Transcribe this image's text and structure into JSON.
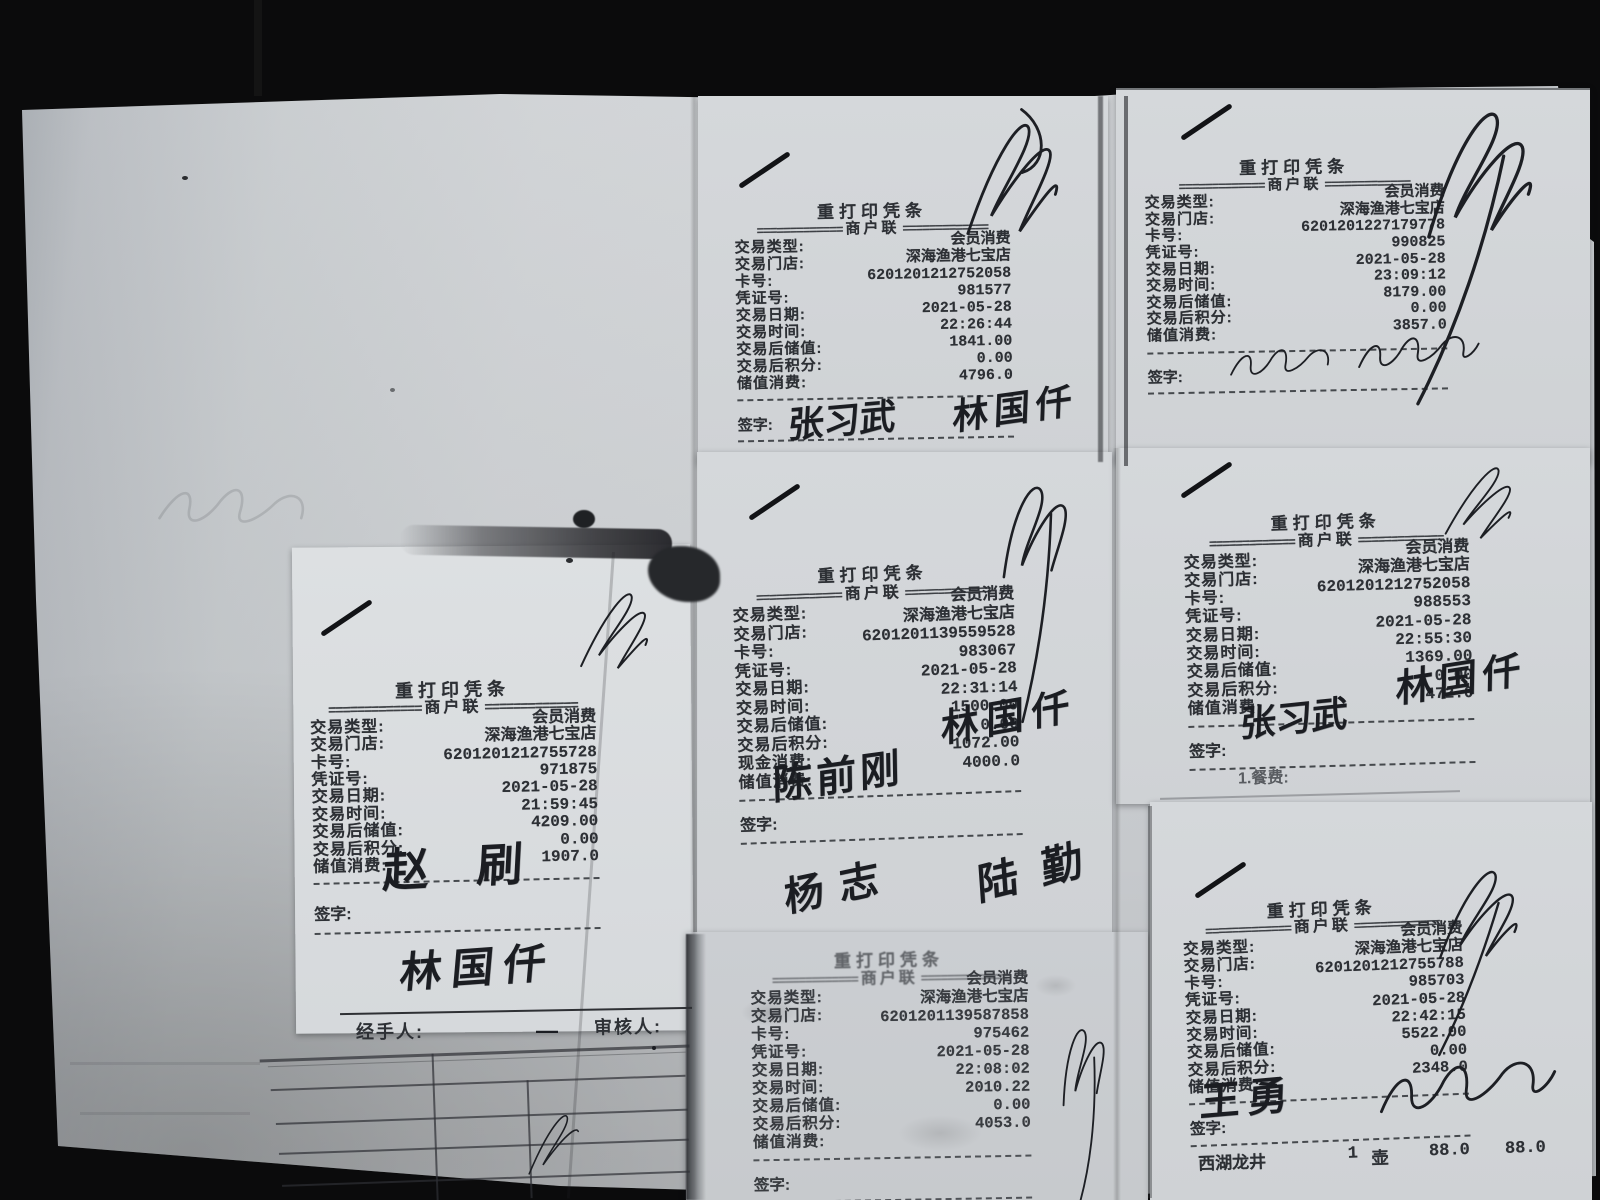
{
  "scene": {
    "background": "#0b0b0c",
    "paper_color": "#ced1d4",
    "slip_color": "#d5d8db",
    "print_ink": "#2d3035",
    "pen_ink": "#1b1d22"
  },
  "chrome": {
    "title": "重打印凭条",
    "sep": "=============",
    "copy": "商户联",
    "sign_label": "签字:"
  },
  "receipts": [
    {
      "name": "top-middle",
      "rows": [
        {
          "label": "交易类型:",
          "value": "会员消费"
        },
        {
          "label": "交易门店:",
          "value": "深海渔港七宝店"
        },
        {
          "label": "卡号:",
          "value": "6201201212752058"
        },
        {
          "label": "凭证号:",
          "value": "981577"
        },
        {
          "label": "交易日期:",
          "value": "2021-05-28"
        },
        {
          "label": "交易时间:",
          "value": "22:26:44"
        },
        {
          "label": "交易后储值:",
          "value": "1841.00"
        },
        {
          "label": "交易后积分:",
          "value": "0.00"
        },
        {
          "label": "储值消费:",
          "value": "4796.0"
        }
      ],
      "signatures": [
        {
          "text": "张习武"
        },
        {
          "text": "林国仟"
        }
      ]
    },
    {
      "name": "top-right",
      "rows": [
        {
          "label": "交易类型:",
          "value": "会员消费"
        },
        {
          "label": "交易门店:",
          "value": "深海渔港七宝店"
        },
        {
          "label": "卡号:",
          "value": "6201201227179778"
        },
        {
          "label": "凭证号:",
          "value": "990825"
        },
        {
          "label": "交易日期:",
          "value": "2021-05-28"
        },
        {
          "label": "交易时间:",
          "value": "23:09:12"
        },
        {
          "label": "交易后储值:",
          "value": "8179.00"
        },
        {
          "label": "交易后积分:",
          "value": "0.00"
        },
        {
          "label": "储值消费:",
          "value": "3857.0"
        }
      ],
      "signatures": []
    },
    {
      "name": "left",
      "rows": [
        {
          "label": "交易类型:",
          "value": "会员消费"
        },
        {
          "label": "交易门店:",
          "value": "深海渔港七宝店"
        },
        {
          "label": "卡号:",
          "value": "6201201212755728"
        },
        {
          "label": "凭证号:",
          "value": "971875"
        },
        {
          "label": "交易日期:",
          "value": "2021-05-28"
        },
        {
          "label": "交易时间:",
          "value": "21:59:45"
        },
        {
          "label": "交易后储值:",
          "value": "4209.00"
        },
        {
          "label": "交易后积分:",
          "value": "0.00"
        },
        {
          "label": "储值消费:",
          "value": "1907.0"
        }
      ],
      "signatures": [
        {
          "text": "赵刷"
        }
      ]
    },
    {
      "name": "middle-center",
      "rows": [
        {
          "label": "交易类型:",
          "value": "会员消费"
        },
        {
          "label": "交易门店:",
          "value": "深海渔港七宝店"
        },
        {
          "label": "卡号:",
          "value": "6201201139559528"
        },
        {
          "label": "凭证号:",
          "value": "983067"
        },
        {
          "label": "交易日期:",
          "value": "2021-05-28"
        },
        {
          "label": "交易时间:",
          "value": "22:31:14"
        },
        {
          "label": "交易后储值:",
          "value": "1500.00"
        },
        {
          "label": "交易后积分:",
          "value": "0.00"
        },
        {
          "label": "现金消费:",
          "value": "1072.00"
        },
        {
          "label": "储值消费:",
          "value": "4000.0"
        }
      ],
      "signatures": [
        {
          "text": "陈前刚"
        },
        {
          "text": "林国仟"
        }
      ]
    },
    {
      "name": "middle-right",
      "rows": [
        {
          "label": "交易类型:",
          "value": "会员消费"
        },
        {
          "label": "交易门店:",
          "value": "深海渔港七宝店"
        },
        {
          "label": "卡号:",
          "value": "6201201212752058"
        },
        {
          "label": "凭证号:",
          "value": "988553"
        },
        {
          "label": "交易日期:",
          "value": "2021-05-28"
        },
        {
          "label": "交易时间:",
          "value": "22:55:30"
        },
        {
          "label": "交易后储值:",
          "value": "1369.00"
        },
        {
          "label": "交易后积分:",
          "value": "0.00"
        },
        {
          "label": "储值消费:",
          "value": "472.0"
        }
      ],
      "signatures": [
        {
          "text": "张习武"
        },
        {
          "text": "林国仟"
        }
      ]
    },
    {
      "name": "bottom-middle",
      "rows": [
        {
          "label": "交易类型:",
          "value": "会员消费"
        },
        {
          "label": "交易门店:",
          "value": "深海渔港七宝店"
        },
        {
          "label": "卡号:",
          "value": "6201201139587858"
        },
        {
          "label": "凭证号:",
          "value": "975462"
        },
        {
          "label": "交易日期:",
          "value": "2021-05-28"
        },
        {
          "label": "交易时间:",
          "value": "22:08:02"
        },
        {
          "label": "交易后储值:",
          "value": "2010.22"
        },
        {
          "label": "交易后积分:",
          "value": "0.00"
        },
        {
          "label": "储值消费:",
          "value": "4053.0"
        }
      ],
      "signatures": []
    },
    {
      "name": "bottom-right",
      "rows": [
        {
          "label": "交易类型:",
          "value": "会员消费"
        },
        {
          "label": "交易门店:",
          "value": "深海渔港七宝店"
        },
        {
          "label": "卡号:",
          "value": "6201201212755788"
        },
        {
          "label": "凭证号:",
          "value": "985703"
        },
        {
          "label": "交易日期:",
          "value": "2021-05-28"
        },
        {
          "label": "交易时间:",
          "value": "22:42:15"
        },
        {
          "label": "交易后储值:",
          "value": "5522.00"
        },
        {
          "label": "交易后积分:",
          "value": "0.00"
        },
        {
          "label": "储值消费:",
          "value": "2348.0"
        }
      ],
      "signatures": [
        {
          "text": "王勇"
        }
      ]
    }
  ],
  "left_form": {
    "handler_label": "经手人:",
    "dash": "—",
    "reviewer_label": "审核人:",
    "signature": "林国仟"
  },
  "stray_signatures": [
    {
      "text": "杨志"
    },
    {
      "text": "陆勤"
    }
  ],
  "notes": {
    "meal_fee": "1.餐费:"
  },
  "bottom_item": {
    "name": "西湖龙井",
    "qty": "1",
    "unit": "壶",
    "price": "88.0",
    "amount": "88.0"
  }
}
